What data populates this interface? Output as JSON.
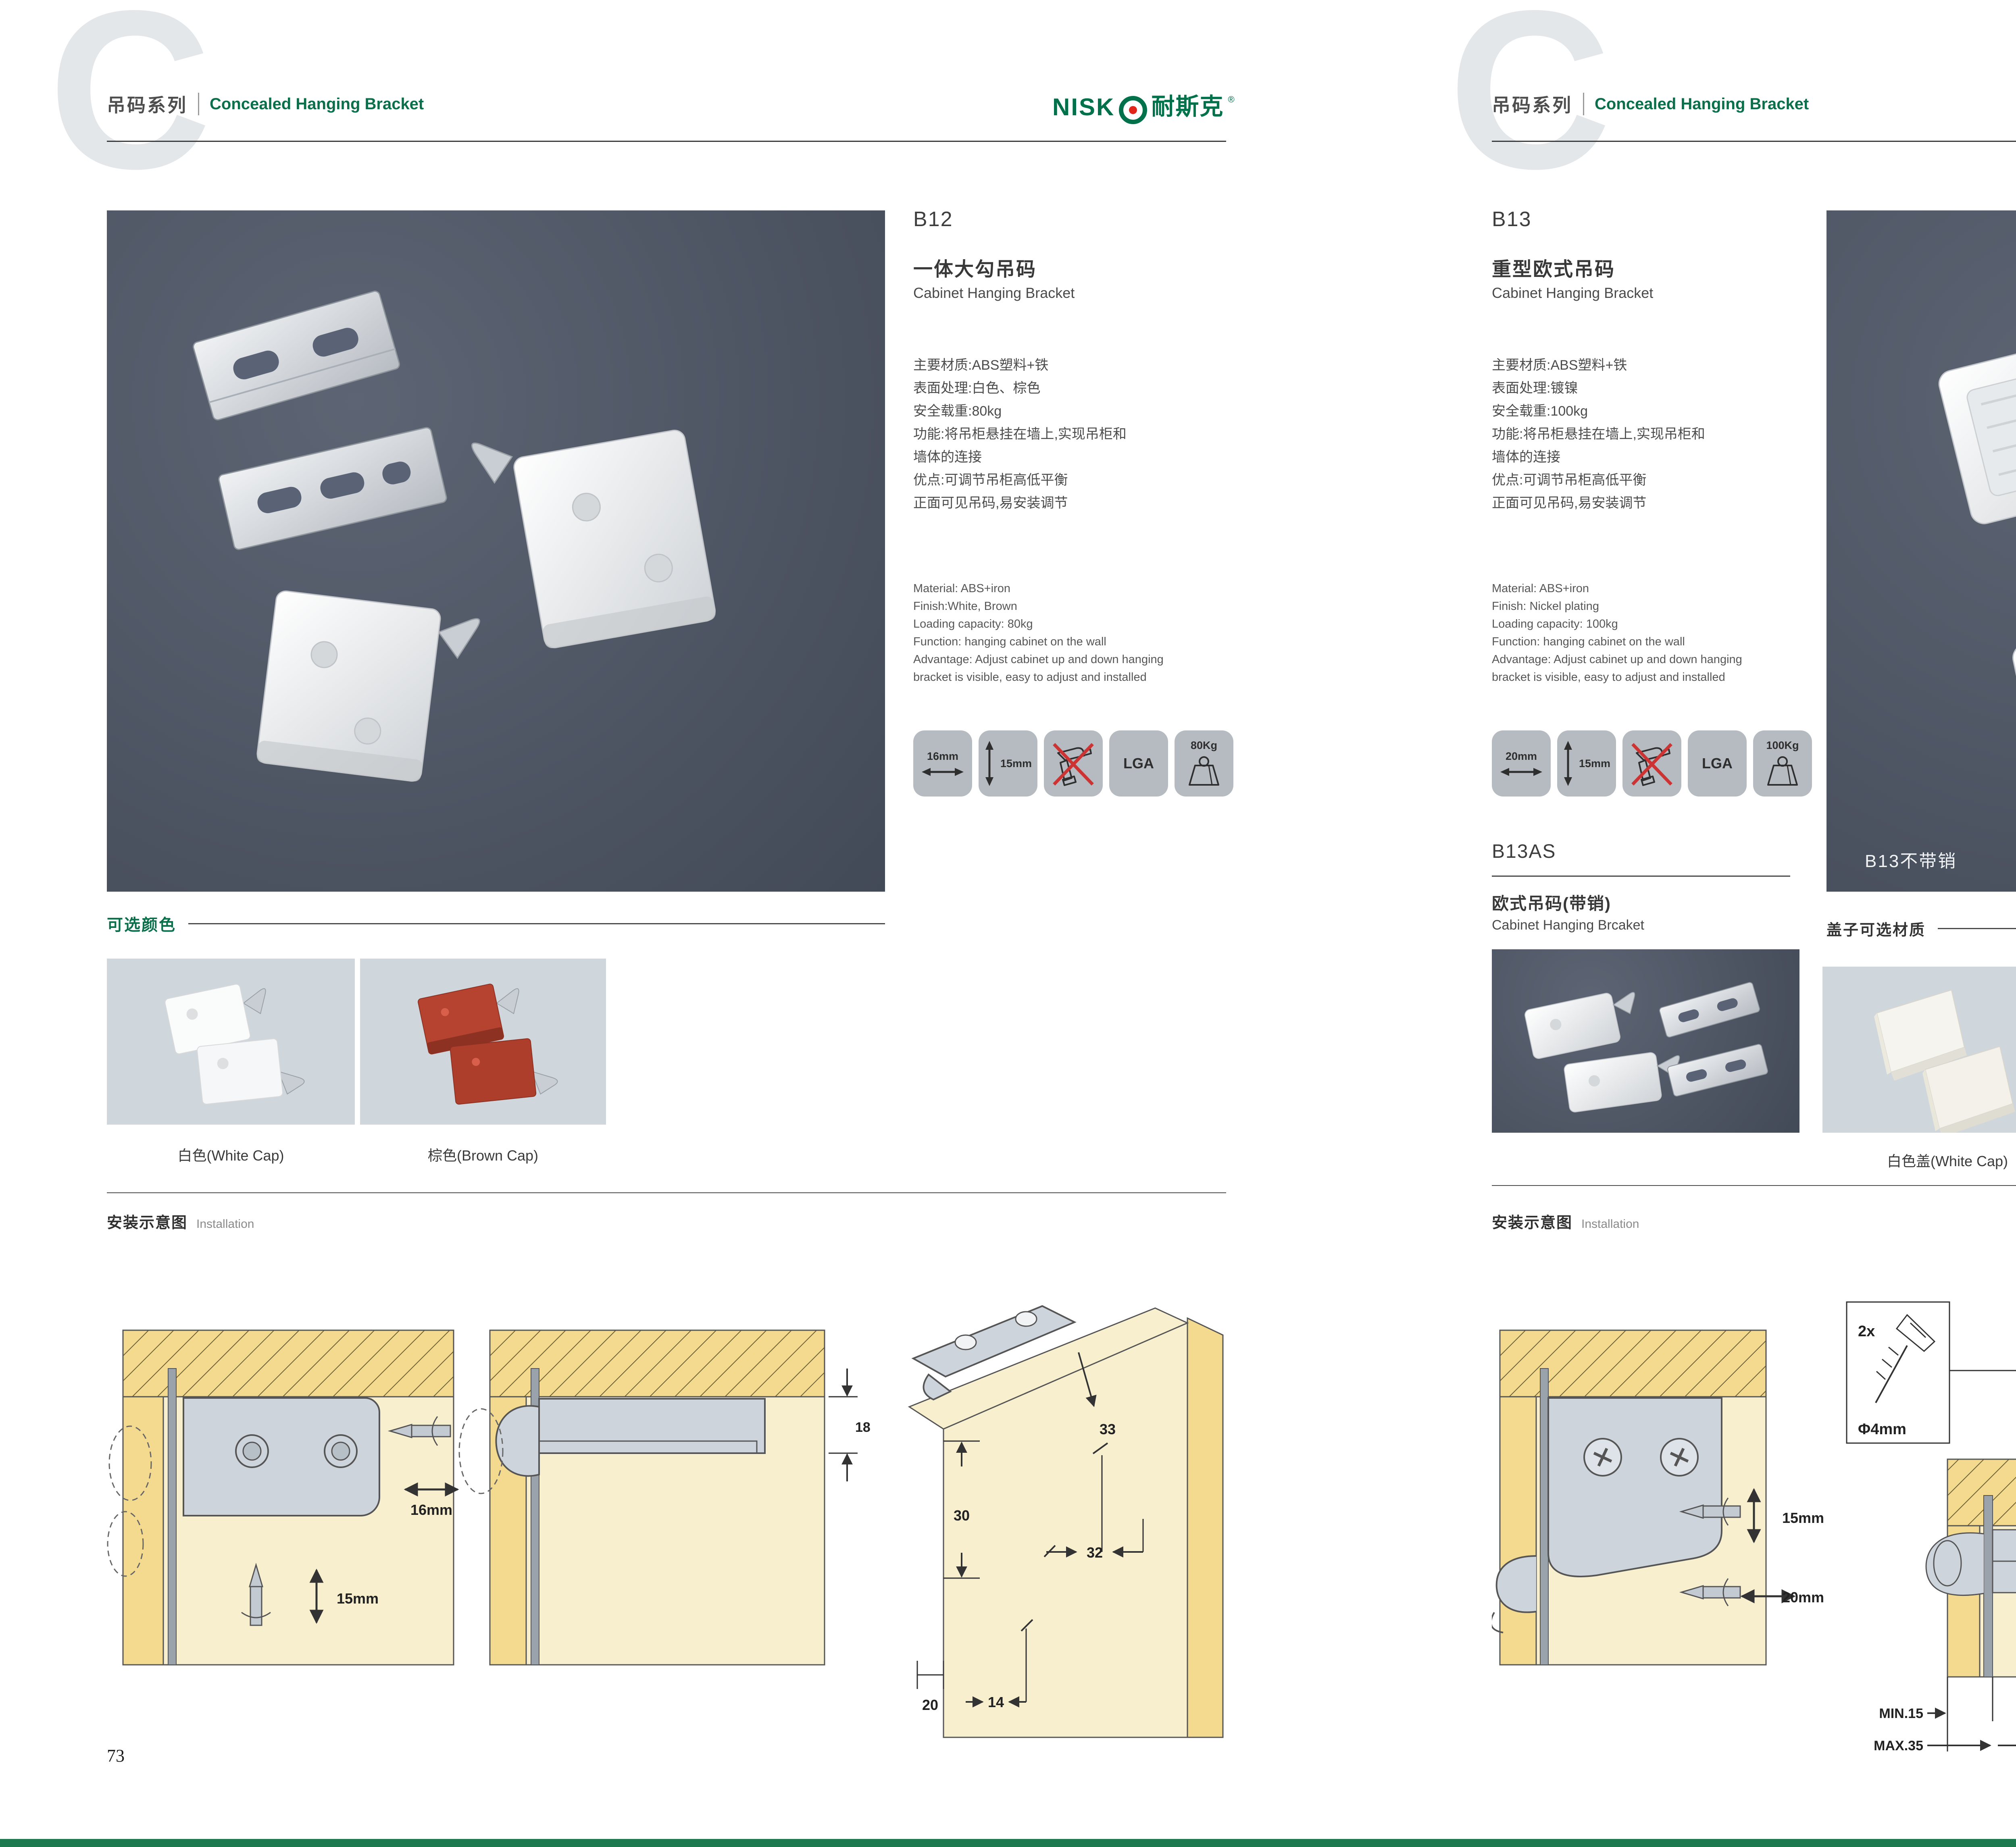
{
  "theme": {
    "brand_green": "#00714a",
    "logo_red": "#e1251b",
    "photo_bg": "#4e5663",
    "swatch_bg": "#cfd6dc",
    "tile_bg": "#b5bbc0",
    "diagram_cream": "#f8efcf",
    "diagram_wood": "#f4da8f",
    "no_drill_red": "#cc3333"
  },
  "brand": {
    "latin": "NISK",
    "cjk": "耐斯克",
    "reg": "®"
  },
  "header": {
    "series_cn": "吊码系列",
    "series_en": "Concealed Hanging Bracket",
    "watermark": "C"
  },
  "footer": {
    "left_page_number": "73",
    "right_page_number": "74"
  },
  "left": {
    "code": "B12",
    "name_cn": "一体大勾吊码",
    "name_en": "Cabinet Hanging Bracket",
    "specs_cn": [
      "主要材质:ABS塑料+铁",
      "表面处理:白色、棕色",
      "安全载重:80kg",
      "功能:将吊柜悬挂在墙上,实现吊柜和",
      "墙体的连接",
      "优点:可调节吊柜高低平衡",
      "正面可见吊码,易安装调节"
    ],
    "specs_en": [
      "Material: ABS+iron",
      "Finish:White, Brown",
      "Loading capacity: 80kg",
      "Function: hanging cabinet on the wall",
      "Advantage: Adjust cabinet up and down hanging",
      "bracket is visible, easy to adjust and installed"
    ],
    "icons": {
      "width": "16mm",
      "height": "15mm",
      "cert": "LGA",
      "load": "80Kg"
    },
    "colors": {
      "title": "可选颜色",
      "labels": [
        "白色(White Cap)",
        "棕色(Brown Cap)"
      ]
    },
    "install": {
      "title_cn": "安装示意图",
      "title_en": "Installation",
      "d1": {
        "dim_w": "16mm",
        "dim_h": "15mm"
      },
      "d2": {
        "dim": "18"
      },
      "d3": {
        "dim_33": "33",
        "dim_30": "30",
        "dim_32": "32",
        "dim_20": "20",
        "dim_14": "14"
      }
    }
  },
  "right": {
    "code": "B13",
    "name_cn": "重型欧式吊码",
    "name_en": "Cabinet Hanging Bracket",
    "specs_cn": [
      "主要材质:ABS塑料+铁",
      "表面处理:镀镍",
      "安全载重:100kg",
      "功能:将吊柜悬挂在墙上,实现吊柜和",
      "墙体的连接",
      "优点:可调节吊柜高低平衡",
      "正面可见吊码,易安装调节"
    ],
    "specs_en": [
      "Material: ABS+iron",
      "Finish: Nickel plating",
      "Loading capacity: 100kg",
      "Function: hanging cabinet on the wall",
      "Advantage: Adjust cabinet up and down hanging",
      "bracket is visible, easy to adjust and installed"
    ],
    "icons": {
      "width": "20mm",
      "height": "15mm",
      "cert": "LGA",
      "load": "100Kg"
    },
    "sub": {
      "code": "B13AS",
      "name_cn": "欧式吊码(带销)",
      "name_en": "Cabinet Hanging Brcaket"
    },
    "photo_caption": "B13不带销",
    "caps": {
      "title": "盖子可选材质",
      "labels": [
        "白色盖(White Cap)",
        "灰色盖(Gray Cap)"
      ]
    },
    "install": {
      "title_cn": "安装示意图",
      "title_en": "Installation",
      "dA": {
        "dim_h": "15mm",
        "dim_w": "20mm"
      },
      "dB": {
        "qty": "2x",
        "dia": "Φ4mm",
        "min": "MIN.15",
        "max": "MAX.35",
        "w": "58",
        "h": "18"
      },
      "dC": {
        "r": "RMAX4",
        "d40": "40",
        "d16": "16",
        "d19": "19",
        "d18": "18",
        "d32": "32"
      }
    }
  }
}
